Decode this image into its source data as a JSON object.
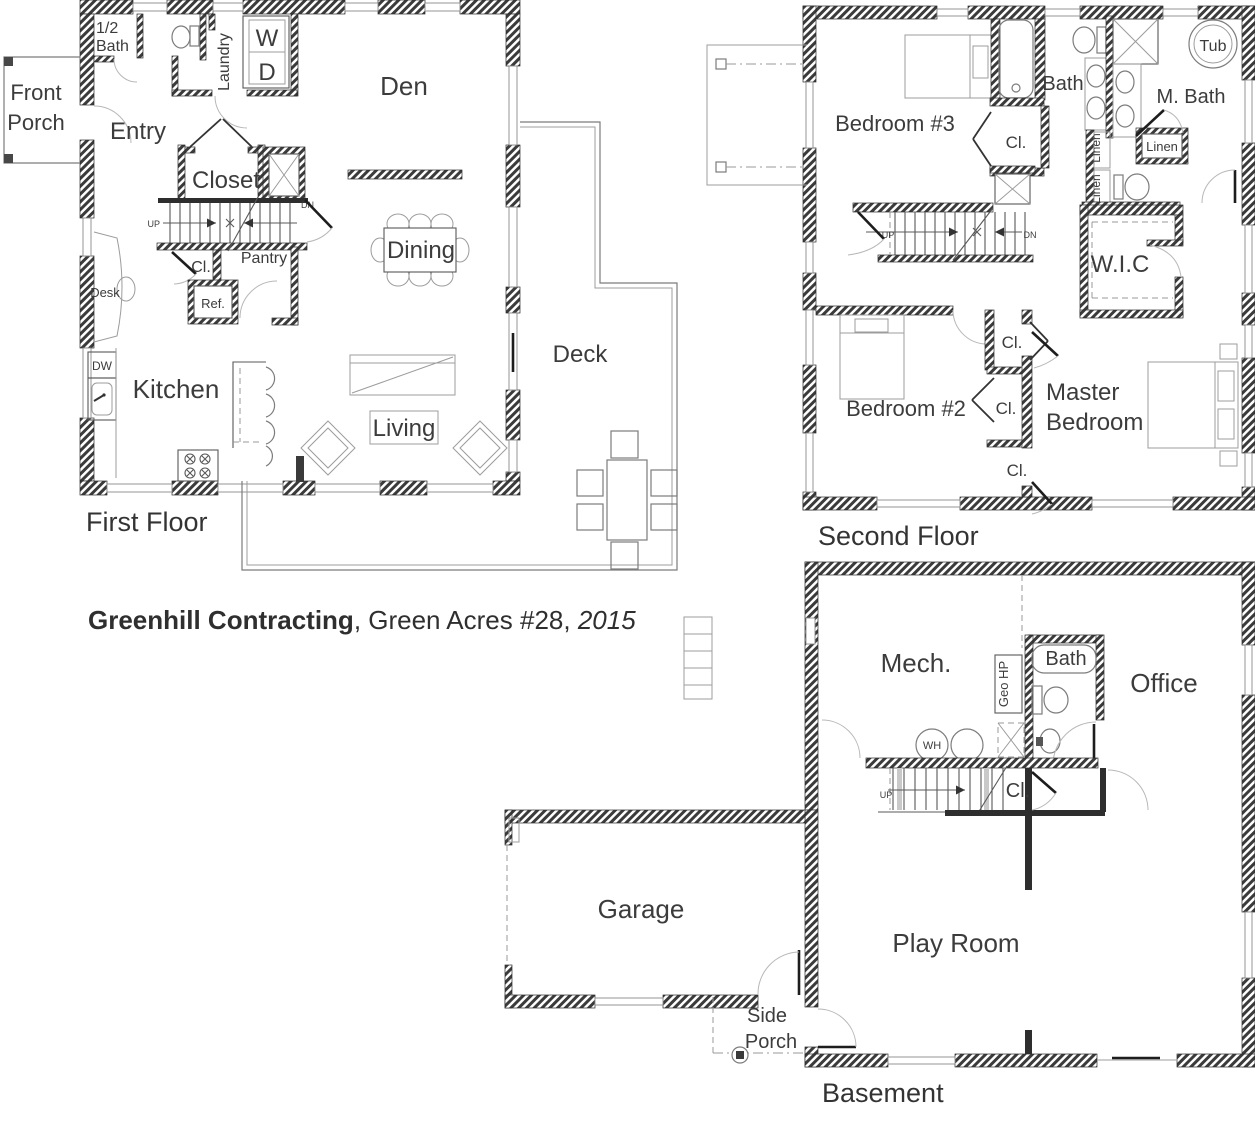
{
  "caption": {
    "builder": "Greenhill Contracting",
    "middle": ", Green Acres #28, ",
    "year": "2015"
  },
  "first_floor": {
    "label": "First Floor",
    "front_porch_line1": "Front",
    "front_porch_line2": "Porch",
    "half_bath_line1": "1/2",
    "half_bath_line2": "Bath",
    "laundry": "Laundry",
    "washer": "W",
    "dryer": "D",
    "entry": "Entry",
    "den": "Den",
    "closet": "Closet",
    "up": "UP",
    "dn": "DN",
    "cl": "Cl.",
    "pantry": "Pantry",
    "ref": "Ref.",
    "desk": "Desk",
    "dw": "DW",
    "kitchen": "Kitchen",
    "dining": "Dining",
    "living": "Living",
    "deck": "Deck"
  },
  "second_floor": {
    "label": "Second Floor",
    "bedroom3": "Bedroom #3",
    "bath": "Bath",
    "m_bath": "M. Bath",
    "tub": "Tub",
    "linen": "Linen",
    "cl": "Cl.",
    "up": "UP",
    "dn": "DN",
    "wic": "W.I.C",
    "bedroom2": "Bedroom #2",
    "master_line1": "Master",
    "master_line2": "Bedroom"
  },
  "basement": {
    "label": "Basement",
    "mech": "Mech.",
    "geo_hp": "Geo HP",
    "bath": "Bath",
    "office": "Office",
    "wh": "WH",
    "up": "UP",
    "cl": "Cl.",
    "play_room": "Play Room",
    "garage": "Garage",
    "side_porch_line1": "Side",
    "side_porch_line2": "Porch"
  }
}
